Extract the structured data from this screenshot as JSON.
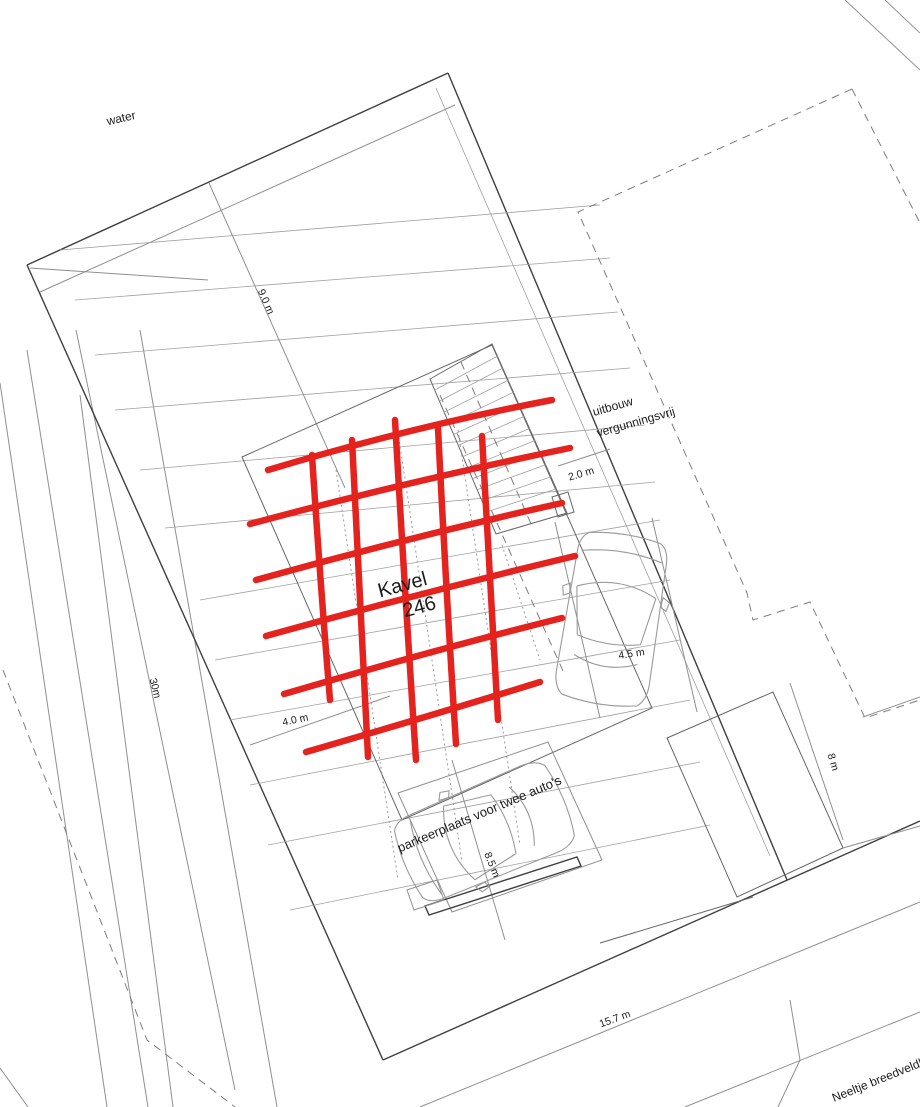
{
  "plan": {
    "plot_label": {
      "line1": "Kavel",
      "line2": "246"
    },
    "annotations": {
      "water": "water",
      "uitbouw_line1": "uitbouw",
      "uitbouw_line2": "vergunningsvrij",
      "parking": "parkeerplaats voor twee auto's",
      "street": "Neeltje breedveldkad"
    },
    "dimensions": {
      "d9": "9.0 m",
      "d2": "2.0 m",
      "d45": "4.5 m",
      "d40": "4.0 m",
      "d85": "8.5 m",
      "d30": "30m",
      "d8": "8 m",
      "d157": "15.7 m"
    },
    "colors": {
      "marker_red": "#e5231e",
      "line_gray": "#8f8f8f",
      "line_dark": "#3f3f3f"
    }
  }
}
